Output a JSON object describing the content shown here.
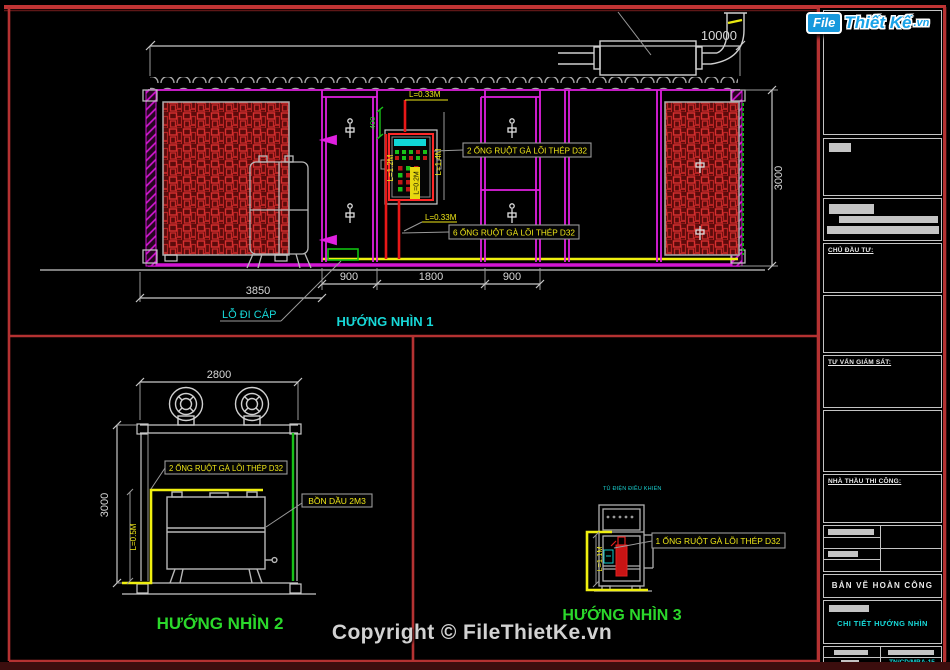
{
  "copyright": "Copyright © FileThietKe.vn",
  "logo": {
    "part1": "File",
    "part2": "Thiết Kế",
    "part3": ".vn"
  },
  "colors": {
    "background": "#000000",
    "panel_border_red": "#b43232",
    "cad_magenta": "#e020e0",
    "cad_yellow": "#f0e818",
    "cad_cyan": "#17d8d8",
    "cad_green": "#2bd82b",
    "cad_red": "#e81818",
    "cad_white": "#d8d8d8",
    "louver_red": "#d83030",
    "logo_blue": "#1aa3e8"
  },
  "views": {
    "v1": {
      "title": "HƯỚNG NHÌN 1",
      "dim_top": "10000",
      "dim_right": "3000",
      "dim_3850": "3850",
      "dim_900a": "900",
      "dim_1800": "1800",
      "dim_900b": "900",
      "dim_400": "400",
      "label_2ong": "2 ỐNG RUỘT GÀ LÕI THÉP D32",
      "label_6ong": "6 ỐNG RUỘT GÀ LÕI THÉP D32",
      "label_cable": "LỖ ĐI CÁP",
      "len_033_top": "L=0.33M",
      "len_033_bot": "L=0.33M",
      "len_14": "L=1.4M",
      "len_12": "L=1.2M",
      "len_02": "L=0.2M"
    },
    "v2": {
      "title": "HƯỚNG NHÌN 2",
      "dim_top": "2800",
      "dim_left": "3000",
      "label_2ong": "2 ỐNG RUỘT GÀ LÕI THÉP D32",
      "label_tank": "BỒN DẦU 2M3",
      "len_05": "L=0.5M"
    },
    "v3": {
      "title": "HƯỚNG NHÌN 3",
      "label_1ong": "1 ỐNG RUỘT GÀ LÕI THÉP D32",
      "len_11": "L=1.1M",
      "cabinet_label": "TỦ ĐIỆN ĐIỀU KHIỂN"
    }
  },
  "titleblock": {
    "chu_dau_tu": "CHỦ ĐẦU TƯ:",
    "tu_van_giam_sat": "TƯ VẤN GIÁM SÁT:",
    "nha_thau_thi_cong": "NHÀ THẦU THI CÔNG:",
    "ban_ve": "BẢN VẼ HOÀN CÔNG",
    "chi_tiet": "CHI TIẾT HƯỚNG NHÌN",
    "drawing_no": "TN/CD/MBA-15"
  }
}
